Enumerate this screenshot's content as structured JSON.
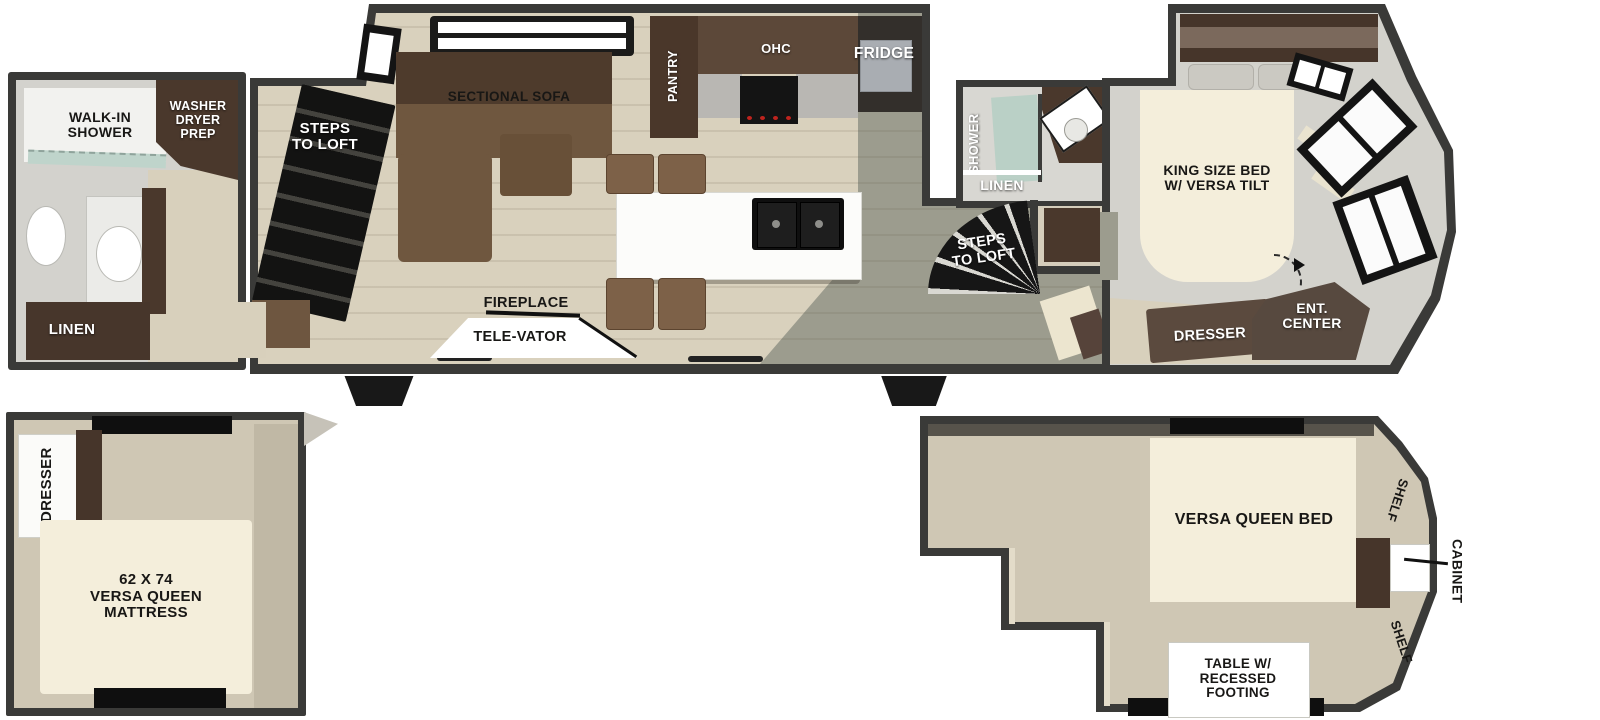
{
  "labels": {
    "rear_bath": {
      "walk_in_shower": "WALK-IN\nSHOWER",
      "washer_dryer_prep": "WASHER\nDRYER\nPREP",
      "linen": "LINEN"
    },
    "living": {
      "steps_to_loft": "STEPS\nTO LOFT",
      "sectional_sofa": "SECTIONAL SOFA",
      "fireplace": "FIREPLACE",
      "televator": "TELE-VATOR"
    },
    "kitchen": {
      "pantry": "PANTRY",
      "ohc": "OHC",
      "fridge": "FRIDGE"
    },
    "mid_bath": {
      "shower": "SHOWER",
      "linen": "LINEN",
      "steps_to_loft": "STEPS\nTO LOFT"
    },
    "bedroom": {
      "king_bed": "KING SIZE BED\nW/ VERSA TILT",
      "dresser": "DRESSER",
      "ent_center": "ENT.\nCENTER"
    },
    "loft_rear": {
      "dresser": "DRESSER",
      "mattress": "62 X 74\nVERSA QUEEN\nMATTRESS"
    },
    "loft_front": {
      "bed": "VERSA QUEEN BED",
      "shelf_top": "SHELF",
      "shelf_bottom": "SHELF",
      "cabinet": "CABINET",
      "table": "TABLE W/\nRECESSED\nFOOTING"
    }
  },
  "colors": {
    "wall": "#3a3a38",
    "floor_wood": "#d9d1bd",
    "floor_gray": "#9c9c8e",
    "floor_tile": "#d8d7d2",
    "loft_floor": "#cfc7b4",
    "cabinet_dark_brown": "#4a382c",
    "sofa_brown": "#6f573f",
    "bed_cream": "#f4eedb",
    "fixture_black": "#141414",
    "glass_green": "#b7cfc4"
  }
}
